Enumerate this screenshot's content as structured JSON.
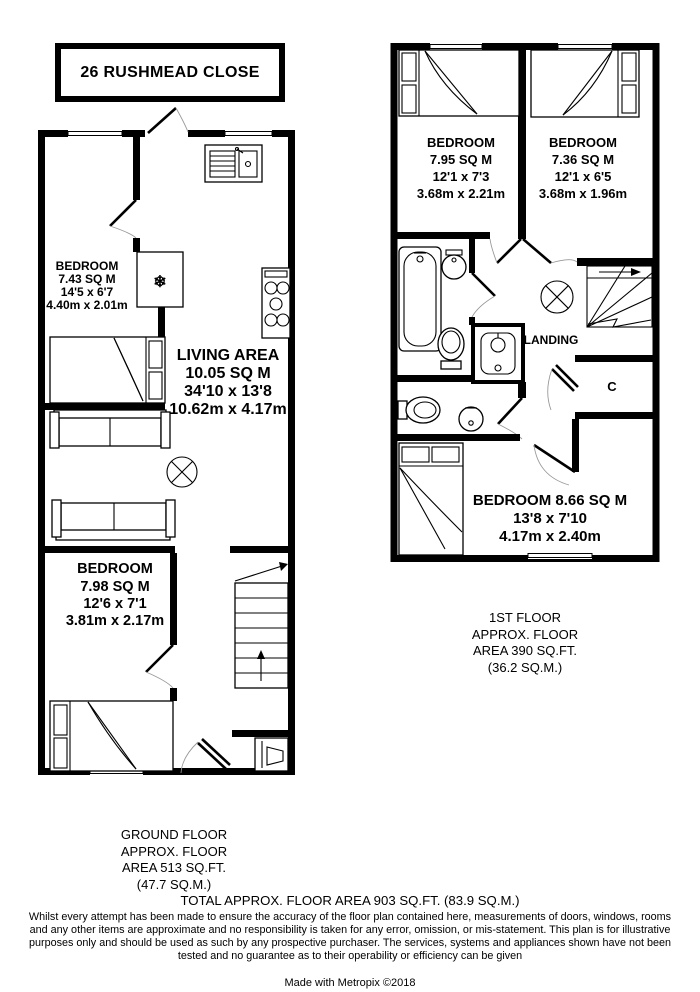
{
  "title": "26 RUSHMEAD CLOSE",
  "colors": {
    "walls": "#000000",
    "counter_fill": "#e7e7e7",
    "background": "#ffffff"
  },
  "icons": {
    "fridge_snowflake": "❄",
    "stairs_up_arrow": "▲"
  },
  "ground_floor": {
    "rooms": {
      "bedroom1": {
        "name": "BEDROOM",
        "area": "7.43 SQ M",
        "imperial": "14'5 x 6'7",
        "metric": "4.40m x 2.01m"
      },
      "living": {
        "name": "LIVING AREA",
        "area": "10.05 SQ M",
        "imperial": "34'10 x 13'8",
        "metric": "10.62m x 4.17m"
      },
      "bedroom2": {
        "name": "BEDROOM",
        "area": "7.98 SQ M",
        "imperial": "12'6 x 7'1",
        "metric": "3.81m x 2.17m"
      }
    },
    "caption": [
      "GROUND FLOOR",
      "APPROX. FLOOR",
      "AREA 513 SQ.FT.",
      "(47.7 SQ.M.)"
    ]
  },
  "first_floor": {
    "rooms": {
      "bedroom1": {
        "name": "BEDROOM",
        "area": "7.95 SQ M",
        "imperial": "12'1 x 7'3",
        "metric": "3.68m x 2.21m"
      },
      "bedroom2": {
        "name": "BEDROOM",
        "area": "7.36 SQ M",
        "imperial": "12'1 x 6'5",
        "metric": "3.68m x 1.96m"
      },
      "bedroom3": {
        "name": "BEDROOM 8.66 SQ M",
        "imperial": "13'8 x 7'10",
        "metric": "4.17m x 2.40m"
      },
      "landing": {
        "name": "LANDING"
      },
      "cupboard": {
        "name": "C"
      }
    },
    "caption": [
      "1ST FLOOR",
      "APPROX. FLOOR",
      "AREA 390 SQ.FT.",
      "(36.2 SQ.M.)"
    ]
  },
  "footer": {
    "total": "TOTAL APPROX. FLOOR AREA 903 SQ.FT. (83.9 SQ.M.)",
    "disclaimer": "Whilst every attempt has been made to ensure the accuracy of the floor plan contained here, measurements of doors, windows, rooms and any other items are approximate and no responsibility is taken for any error, omission, or mis-statement. This plan is for illustrative purposes only and should be used as such by any prospective purchaser. The services, systems and appliances shown have not been tested and no guarantee as to their operability or efficiency can be given",
    "credit": "Made with Metropix ©2018"
  }
}
